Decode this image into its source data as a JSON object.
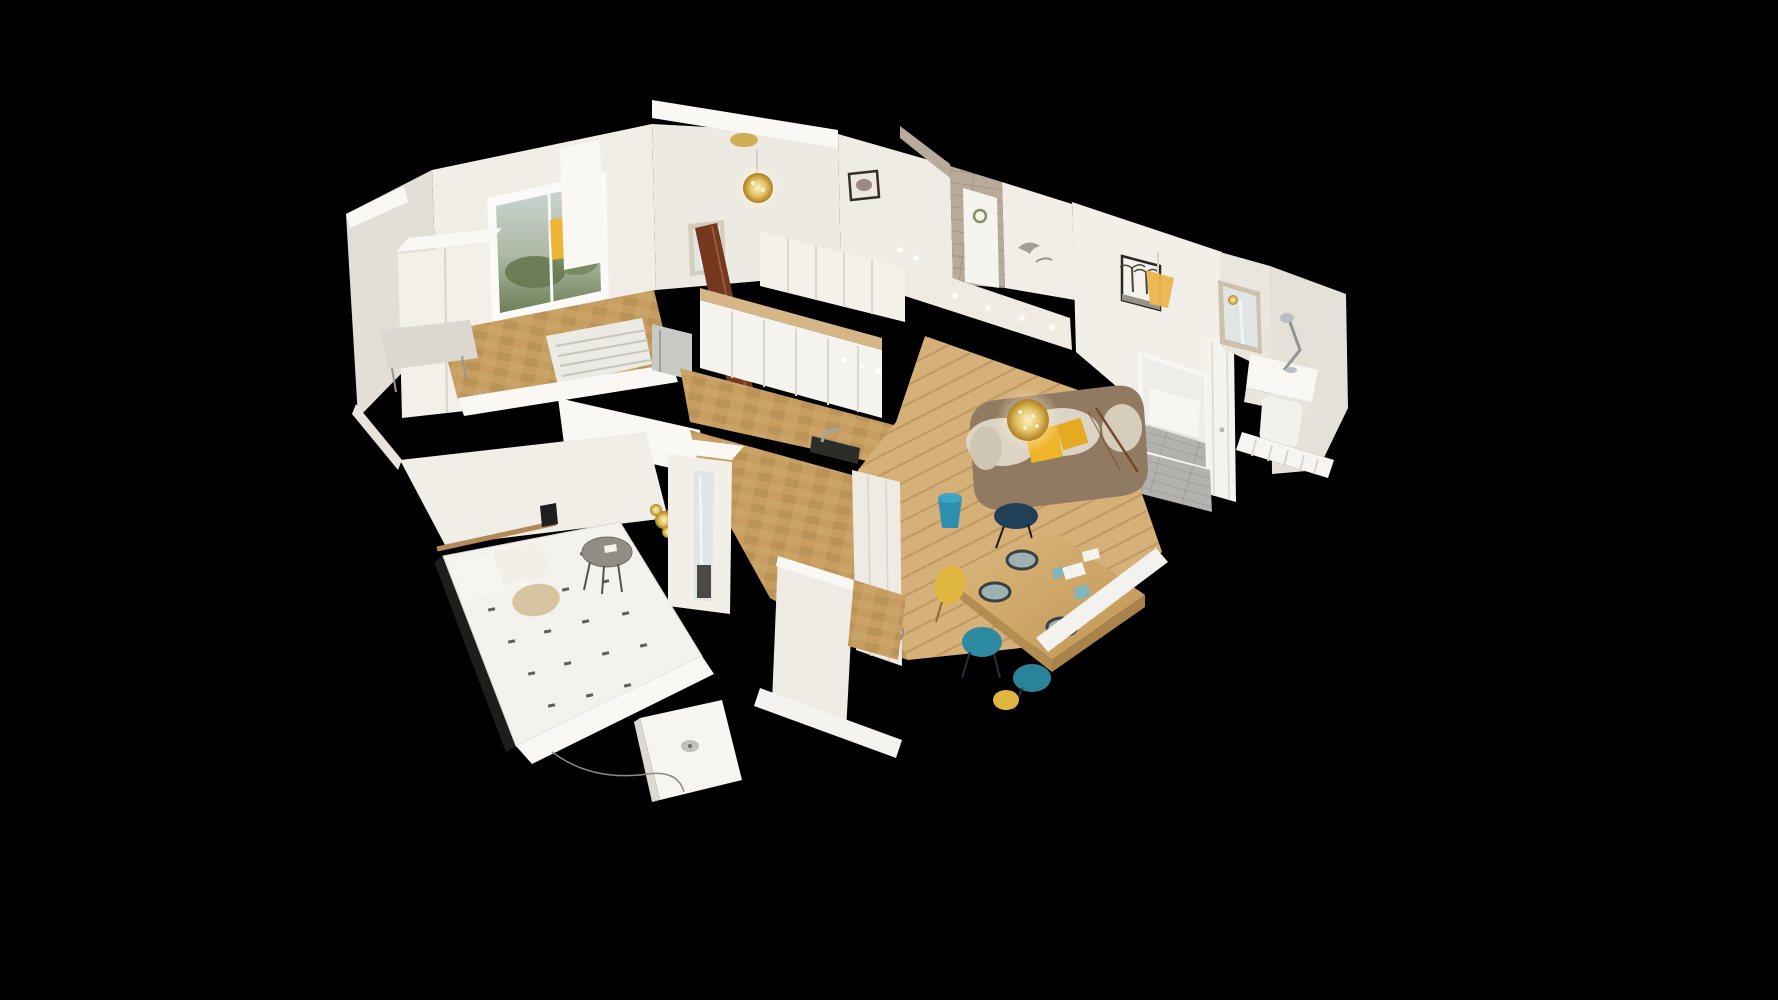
{
  "scene": {
    "label": "3D dollhouse cutaway view of a furnished apartment",
    "view_mode": "dollhouse",
    "background": "#000000"
  },
  "rooms": [
    {
      "id": "window-room",
      "label": "Room with garden window",
      "furniture": [
        "white wardrobe",
        "window with garden view",
        "yellow pendant lamp",
        "white bench",
        "radiator grille",
        "parquet floor"
      ]
    },
    {
      "id": "entrance-hall",
      "label": "Entrance hall",
      "furniture": [
        "gold chandelier",
        "framed mirror",
        "open dark-wood door",
        "framed print"
      ]
    },
    {
      "id": "shower-room",
      "label": "Shower room",
      "furniture": [
        "beige tiled shower wall",
        "glass shower panel",
        "small framed print",
        "bird wall art"
      ]
    },
    {
      "id": "kitchen",
      "label": "Kitchen",
      "furniture": [
        "white upper cabinets",
        "worktop",
        "refrigerator",
        "black cooktop strip",
        "sink tap",
        "under-cabinet lights"
      ]
    },
    {
      "id": "living-room",
      "label": "Living room",
      "furniture": [
        "beige sofa",
        "yellow cushions",
        "sparkling gold chandelier",
        "wood dining table",
        "dinner plates",
        "teal chairs",
        "yellow chairs",
        "palm-tree print",
        "yellow pendant lamp",
        "blue bucket",
        "plate on floor",
        "herringbone parquet"
      ]
    },
    {
      "id": "second-bedroom",
      "label": "Second bedroom",
      "furniture": [
        "white bed",
        "grey plank floor",
        "tall white door"
      ]
    },
    {
      "id": "desk-nook",
      "label": "Desk corner",
      "furniture": [
        "framed mirror",
        "white desk",
        "metal desk lamp",
        "white chair cushion",
        "radiator"
      ]
    },
    {
      "id": "main-bedroom",
      "label": "Main bedroom",
      "furniture": [
        "double bed with dotted duvet",
        "wall shelf",
        "wall lamp",
        "round side table",
        "golden plant",
        "mirrored wardrobe",
        "tall wall",
        "white desk",
        "parquet floor"
      ]
    }
  ],
  "palette": {
    "bg": "#000000",
    "wall": "#f1eee7",
    "wallShade": "#e3dfd6",
    "wallBright": "#f9f8f4",
    "wallDark": "#cfcac0",
    "floorWood": "#c89e60",
    "floorWoodLight": "#d6b079",
    "floorGray": "#b4b2af",
    "tile": "#b9ab9a",
    "doorWood": "#74381f",
    "sofaBody": "#907a62",
    "sofaCushion": "#dcd4c5",
    "accentYellow": "#f1b52c",
    "gold": "#c9a33a",
    "chairTeal": "#2e8aa0",
    "chairNavy": "#223f58",
    "chairYellow": "#dfb640",
    "tableWood": "#d2a96b",
    "bedLinen": "#f4f2ed",
    "pillowBeige": "#d7c5a2",
    "mirrorGlass": "#e0e5e5",
    "windowSky": "#cfd8da",
    "windowGreen": "#6d7f58",
    "applianceGray": "#c9c9c6"
  }
}
